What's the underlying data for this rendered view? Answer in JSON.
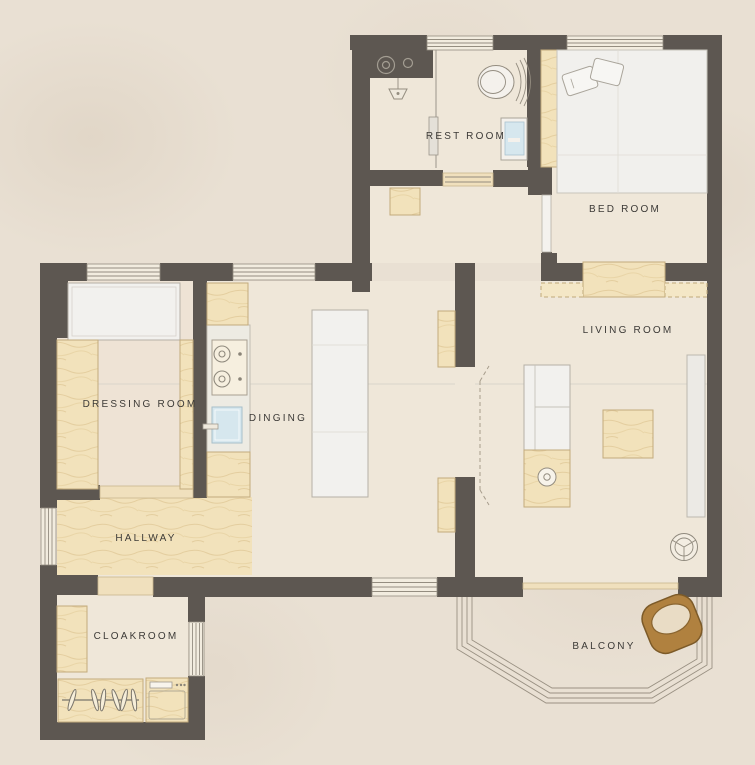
{
  "title": "apartment-floor-plan",
  "rooms": {
    "rest_room": "REST ROOM",
    "bed_room": "BED ROOM",
    "living_room": "LIVING ROOM",
    "dressing_room": "DRESSING ROOM",
    "dining": "DINGING",
    "hallway": "HALLWAY",
    "cloakroom": "CLOAKROOM",
    "balcony": "BALCONY"
  },
  "palette": {
    "wall": "#5d5751",
    "floor": "#efe7d9",
    "outside": "#e9e0d3",
    "wood": "#f2e2bb",
    "wood-edge": "#c3ab7c",
    "white-item": "#f2f1ee",
    "item-edge": "#b5b0a6",
    "window-fill": "#f2ecdf",
    "line": "#948d80",
    "blue": "#d6e7ee",
    "brown": "#b0813f",
    "text": "#3c3a37"
  }
}
